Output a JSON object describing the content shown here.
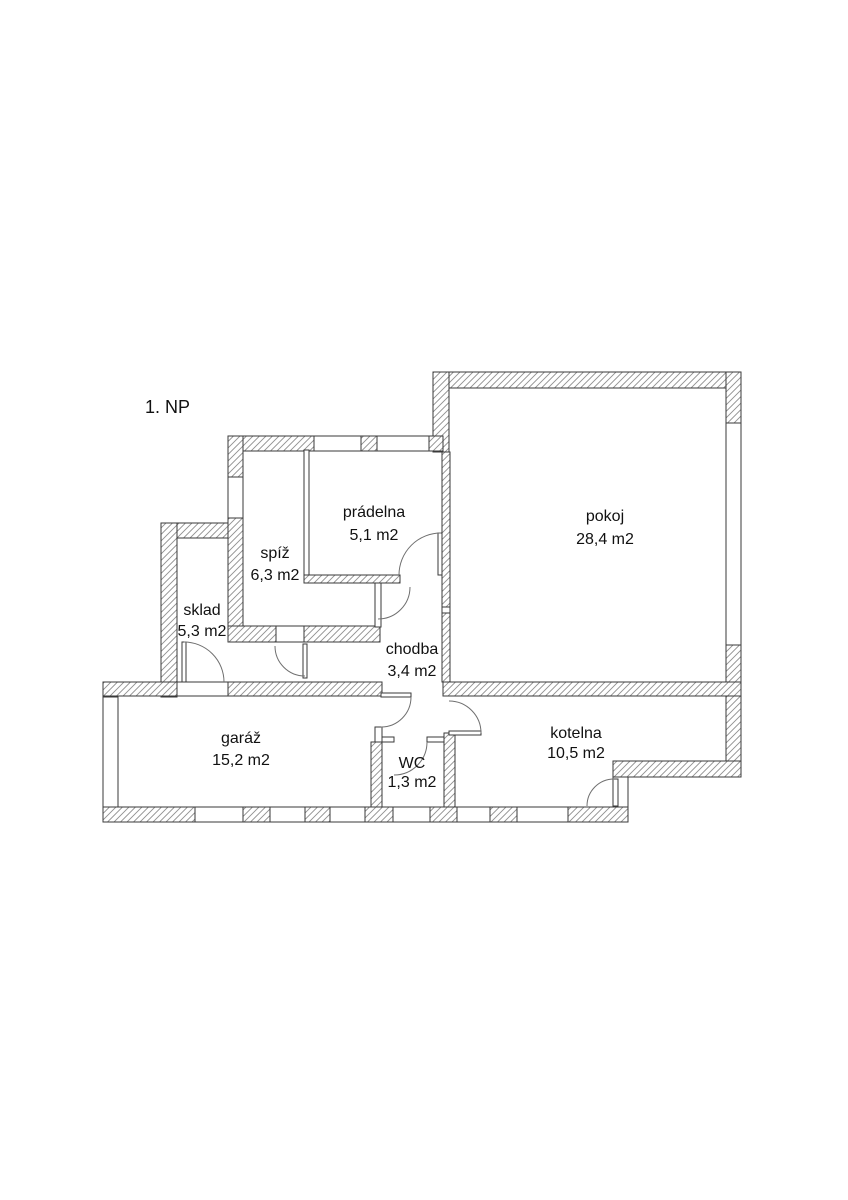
{
  "title": "1. NP",
  "rooms": [
    {
      "name": "prádelna",
      "area": "5,1 m2"
    },
    {
      "name": "pokoj",
      "area": "28,4 m2"
    },
    {
      "name": "spíž",
      "area": "6,3 m2"
    },
    {
      "name": "sklad",
      "area": "5,3 m2"
    },
    {
      "name": "chodba",
      "area": "3,4 m2"
    },
    {
      "name": "garáž",
      "area": "15,2 m2"
    },
    {
      "name": "WC",
      "area": "1,3 m2"
    },
    {
      "name": "kotelna",
      "area": "10,5 m2"
    }
  ],
  "colors": {
    "background": "#ffffff",
    "wall_outline": "#3a3a3a",
    "hatch_line": "#8f8f8f",
    "door_arc": "#6f6f6f",
    "text": "#111111"
  }
}
